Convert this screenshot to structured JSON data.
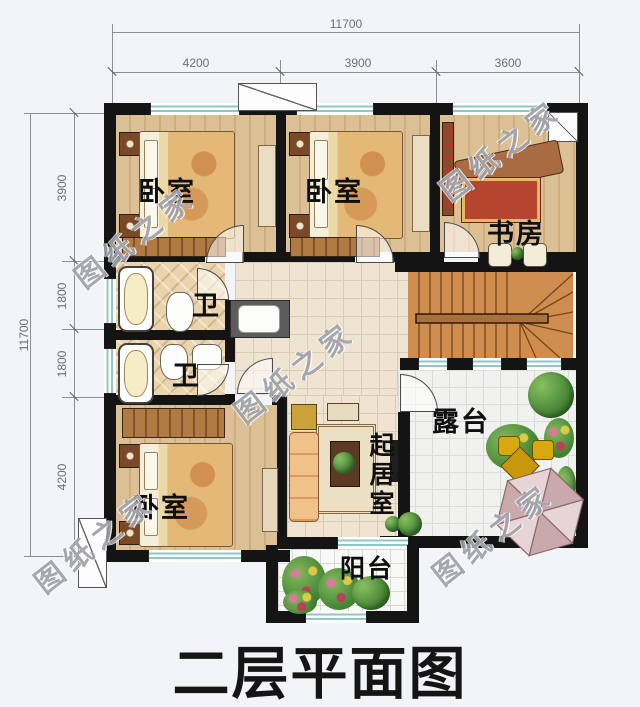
{
  "title": "二层平面图",
  "watermark_text": "图纸之家",
  "dimensions": {
    "top": {
      "total": "11700",
      "segments": [
        "4200",
        "3900",
        "3600"
      ]
    },
    "left": {
      "total": "11700",
      "segments": [
        "3900",
        "1800",
        "1800",
        "4200"
      ]
    }
  },
  "rooms": {
    "bedroom1": "卧室",
    "bedroom2": "卧室",
    "study": "书房",
    "bath1": "卫",
    "bath2": "卫",
    "bedroom3": "卧室",
    "living": "起居室",
    "terrace": "露台",
    "balcony": "阳台"
  },
  "colors": {
    "wall": "#141414",
    "wood_floor": "#d9bd92",
    "hall_tile": "#efe3d1",
    "bath_tile": "#ead4ad",
    "stair": "#cf8d4f",
    "terrace_tile": "#f1f2ef",
    "window_glass": "#8fc6c6",
    "umbrella": "#e0c9cc",
    "plant_green": "#4e8c3a"
  }
}
